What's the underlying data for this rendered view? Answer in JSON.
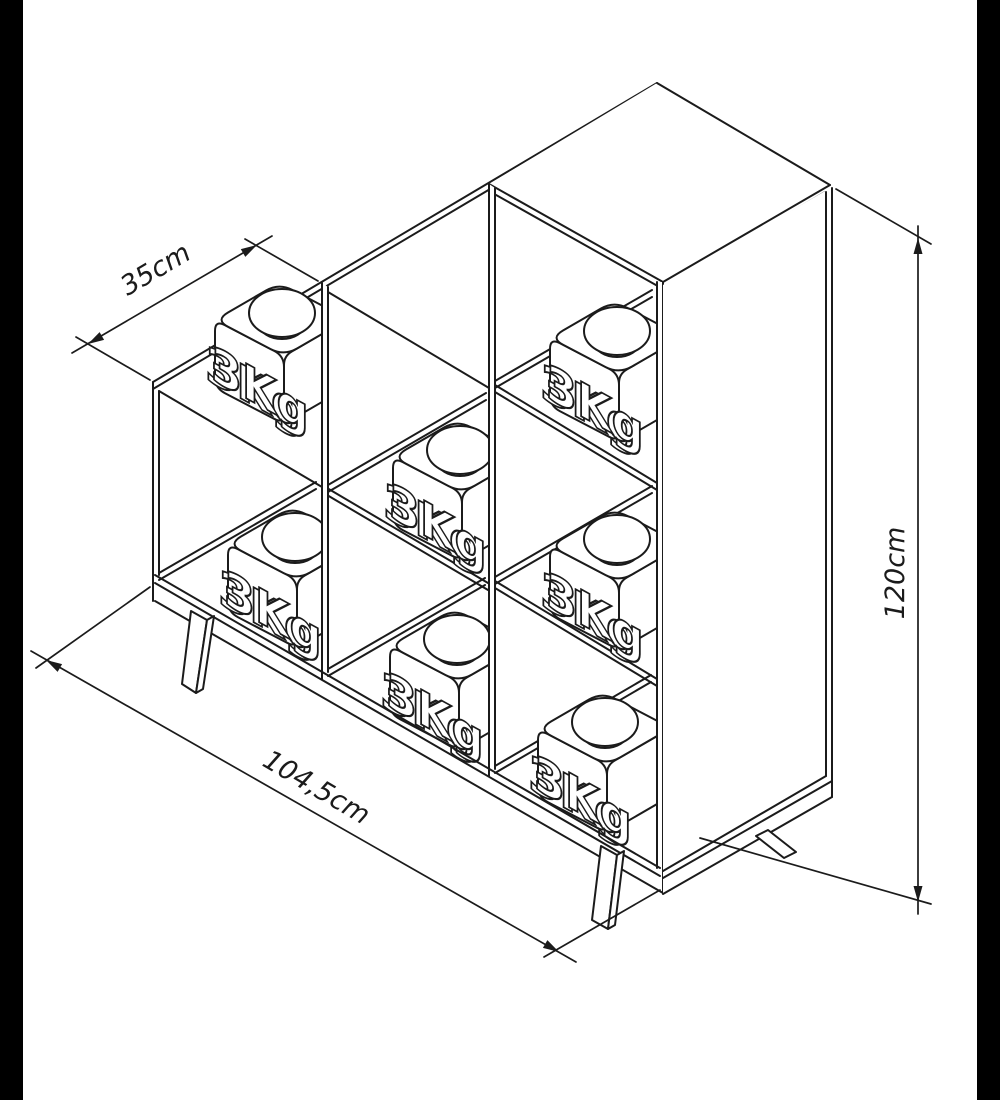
{
  "diagram": {
    "type": "isometric furniture dimensional drawing",
    "subject": "step bookcase with three columns loaded with test weights",
    "dimensions": {
      "column_width": {
        "label": "35cm"
      },
      "total_width": {
        "label": "104,5cm"
      },
      "height": {
        "label": "120cm"
      }
    },
    "weights": [
      {
        "label": "3Kg"
      },
      {
        "label": "3Kg"
      },
      {
        "label": "3Kg"
      },
      {
        "label": "3Kg"
      },
      {
        "label": "3Kg"
      },
      {
        "label": "3Kg"
      },
      {
        "label": "3Kg"
      }
    ],
    "colors": {
      "line": "#1b1b1b",
      "background": "#ffffff",
      "frame_bars": "#000000"
    }
  }
}
